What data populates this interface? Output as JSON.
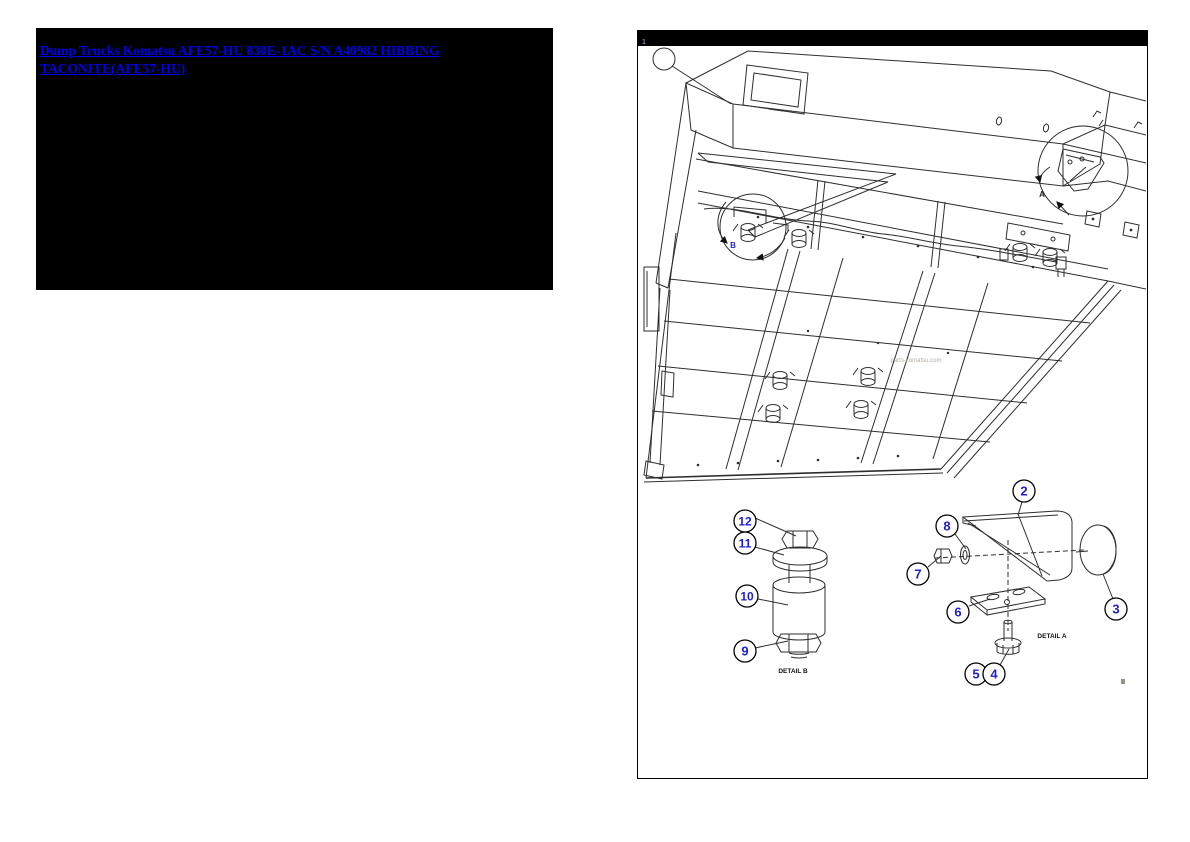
{
  "left_panel": {
    "link_text": "Dump Trucks Komatsu AFE57-HU 830E-1AC S/N A40982 HIBBING TACONITE(AFE57-HU)"
  },
  "diagram": {
    "corner_mark": "1",
    "watermark": "parts-komatsu.com",
    "main_view": {
      "detail_a_label": "A",
      "detail_b_label": "B"
    },
    "detail_a": {
      "caption": "DETAIL A",
      "balloons": {
        "b2": "2",
        "b3": "3",
        "b4": "4",
        "b5": "5",
        "b6": "6",
        "b7": "7",
        "b8": "8"
      }
    },
    "detail_b": {
      "caption": "DETAIL B",
      "balloons": {
        "b9": "9",
        "b10": "10",
        "b11": "11",
        "b12": "12"
      }
    }
  },
  "colors": {
    "link": "#0000ee",
    "balloon_text": "#1f1fcf",
    "line": "#2e2e2e",
    "panel_bg": "#000000"
  }
}
